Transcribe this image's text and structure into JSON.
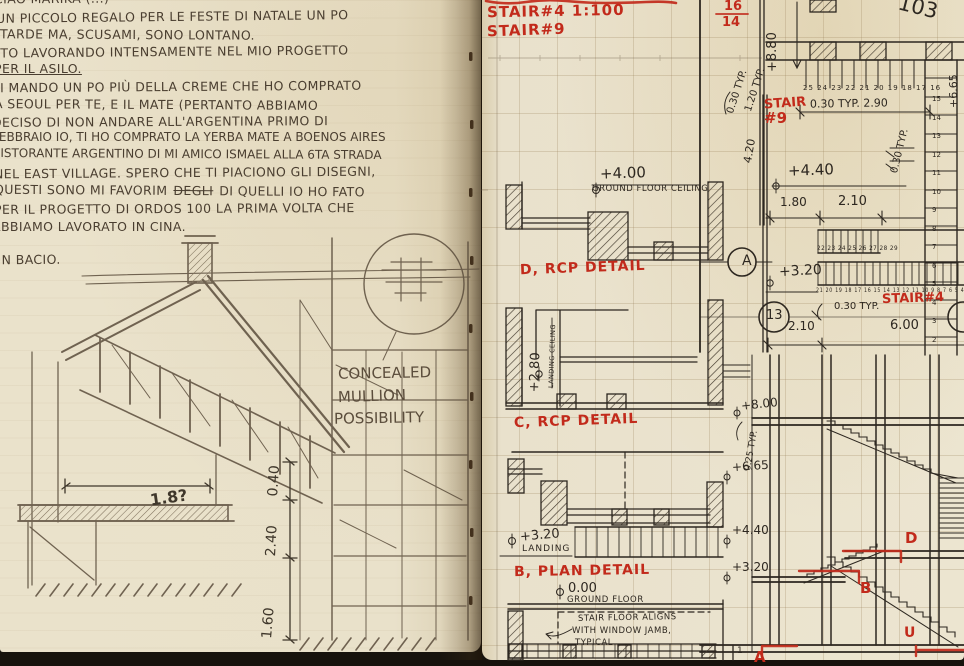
{
  "colors": {
    "red_ink": "#c22a1b",
    "black_ink": "#2d2720",
    "pencil": "#5b4d3c",
    "paper_left": "#eae2cb",
    "paper_right": "#ece5d0"
  },
  "left_page": {
    "letter": {
      "lines": [
        "CIAO MARIKA (...)",
        "UN PICCOLO REGALO PER LE FESTE DI NATALE UN PO",
        "TARDE MA, SCUSAMI, SONO LONTANO.",
        "STO LAVORANDO INTENSAMENTE NEL MIO PROGETTO",
        "PER IL ASILO.",
        "TI MANDO UN PO PIÙ DELLA CREME CHE HO COMPRATO",
        "A SEOUL PER TE, E IL MATE (PERTANTO ABBIAMO",
        "DECISO DI NON ANDARE ALL'ARGENTINA PRIMO DI",
        "FEBBRAIO IO, TI HO COMPRATO LA YERBA MATE A BOENOS AIRES",
        "RISTORANTE ARGENTINO DI MI AMICO ISMAEL ALLA 6TA STRADA",
        "NEL EAST VILLAGE. SPERO CHE TI PIACIONO GLI DISEGNI,"
      ],
      "line12_pre": "QUESTI SONO MI FAVORIM",
      "line12_strike": "DEGLI",
      "line12_post": "DI QUELLI IO HO FATO",
      "line13": "PER IL PROGETTO DI ORDOS 100 LA PRIMA VOLTA CHE",
      "line14": "ABBIAMO LAVORATO IN CINA.",
      "line15": "UN BACIO."
    },
    "sketch": {
      "bubble_note_1": "CONCEALED",
      "bubble_note_2": "MULLION",
      "bubble_note_3": "POSSIBILITY",
      "dim_width": "1.8?",
      "dim_top": "0.40",
      "dim_mid": "2.40",
      "dim_bottom": "1.60"
    }
  },
  "right_page": {
    "page_number": "103",
    "title_line1": "STAIR#4 1:100",
    "title_line2": "STAIR#9",
    "sheet_fraction_top": "16",
    "sheet_fraction_bottom": "14",
    "stair9_label_1": "STAIR",
    "stair9_label_2": "#9",
    "stair4_label": "STAIR#4",
    "grid_bubble": "13",
    "section_bubble": "A",
    "levels": {
      "v880": "+8.80",
      "v665": "+6.65",
      "p440": "+4.40",
      "p320": "+3.20",
      "l400": "+4.00",
      "l400_sub": "GROUND FLOOR CEILING",
      "l280": "+2.80",
      "l280_sub": "LANDING CEILING",
      "l320_landing": "+3.20",
      "l320_landing_sub": "LANDING",
      "l000": "0.00",
      "l000_sub": "GROUND FLOOR",
      "r800": "+8.00",
      "r665": "+6.65",
      "r440": "+4.40",
      "r320": "+3.20"
    },
    "dims": {
      "d030_rot_a": "0.30 TYP.",
      "d120_rot": "1.20 TYP.",
      "d030_290": "0.30 TYP.   2.90",
      "d030_rot_b": "0.30 TYP.",
      "d420_rot": "4.20",
      "d180": "1.80",
      "d210a": "2.10",
      "d030_c": "0.30 TYP.",
      "d210b": "2.10",
      "d600": "6.00",
      "d025_rot": "0.25 TYP."
    },
    "tread_numbers": {
      "plan_top": "25 24 23 22 21 20 19 18 17 16",
      "right_column": "15\n14\n13\n12\n11\n10\n9\n8\n7\n6\n5\n4\n3\n2",
      "mid_run": "22 23 24 25 26 27 28 29",
      "long_run": "21 20 19 18 17 16 15 14 13 12 11 10 9 8 7 6 5 4"
    },
    "detail_labels": {
      "d_rcp": "D, RCP DETAIL",
      "c_rcp": "C, RCP DETAIL",
      "b_plan": "B, PLAN DETAIL"
    },
    "note_line1": "STAIR FLOOR ALIGNS",
    "note_line2": "WITH WINDOW JAMB,",
    "note_line3": "TYPICAL",
    "section_marks": {
      "d": "D",
      "b": "B",
      "u": "U",
      "a": "A"
    },
    "misc": {
      "small_one": "1"
    }
  }
}
